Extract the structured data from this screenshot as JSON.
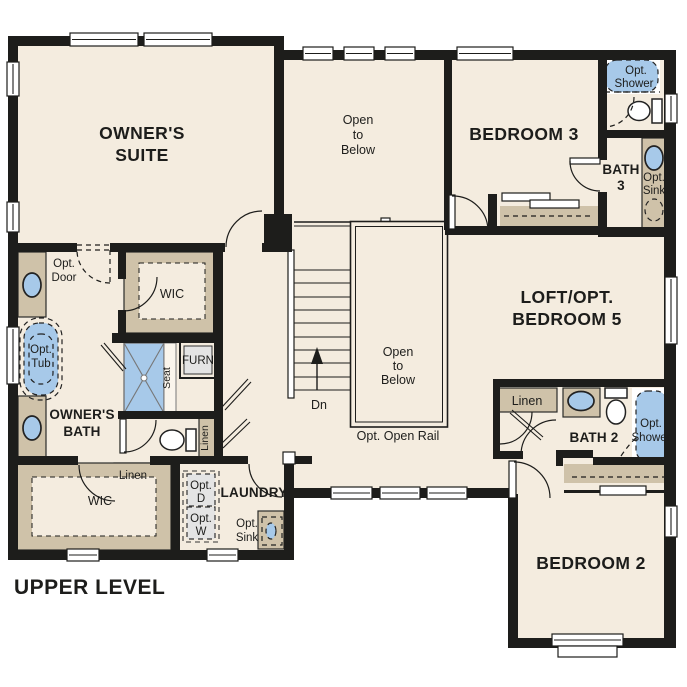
{
  "title": "UPPER LEVEL",
  "colors": {
    "floor": "#f4ecdf",
    "wall": "#1d1d1b",
    "cabinet": "#cfc2a9",
    "fixture_blue": "#a7c9e9",
    "appliance_gray": "#e4e4e4",
    "background": "#ffffff"
  },
  "labels": {
    "owners_suite": [
      "OWNER'S",
      "SUITE"
    ],
    "open_below_top": [
      "Open",
      "to",
      "Below"
    ],
    "bedroom3": "BEDROOM 3",
    "opt_shower_b3": [
      "Opt.",
      "Shower"
    ],
    "bath3": [
      "BATH",
      "3"
    ],
    "opt_sink_b3": [
      "Opt.",
      "Sink"
    ],
    "loft": [
      "LOFT/OPT.",
      "BEDROOM 5"
    ],
    "opt_door": [
      "Opt.",
      "Door"
    ],
    "wic_owner": "WIC",
    "furn": "FURN",
    "seat": "Seat",
    "opt_tub": [
      "Opt.",
      "Tub"
    ],
    "owners_bath": [
      "OWNER'S",
      "BATH"
    ],
    "linen_hall": "Linen",
    "linen_wic": "Linen",
    "wic_lower": "WIC",
    "laundry": "LAUNDRY",
    "opt_d": [
      "Opt.",
      "D"
    ],
    "opt_w": [
      "Opt.",
      "W"
    ],
    "opt_sink_laundry": [
      "Opt.",
      "Sink"
    ],
    "open_below_center": [
      "Open",
      "to",
      "Below"
    ],
    "dn": "Dn",
    "opt_open_rail": "Opt. Open Rail",
    "linen_bath2": "Linen",
    "bath2": "BATH 2",
    "opt_shower_b2": [
      "Opt.",
      "Shower"
    ],
    "bedroom2": "BEDROOM 2",
    "upper_level": "UPPER LEVEL"
  }
}
